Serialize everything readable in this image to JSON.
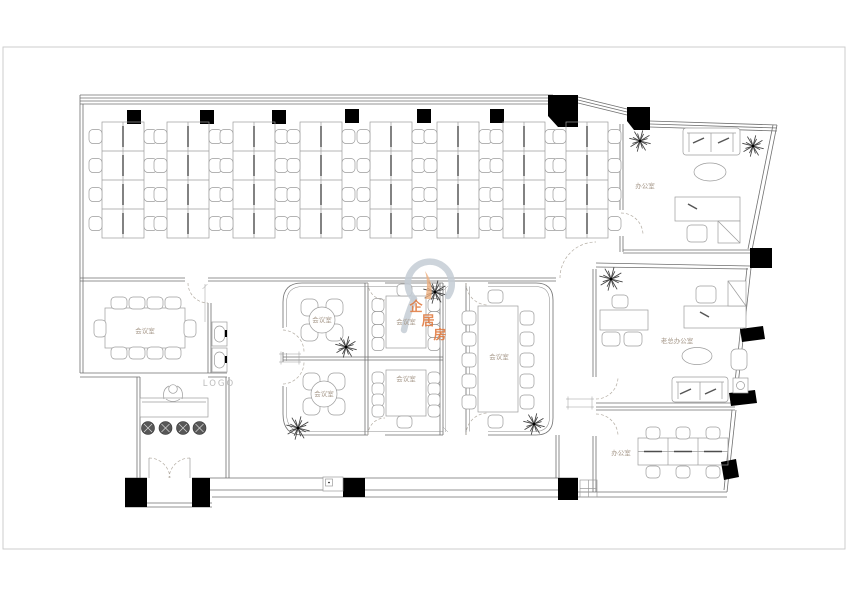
{
  "page": {
    "type": "office-floor-plan"
  },
  "labels": {
    "conf_left": "会议室",
    "conf_small_tl": "会议室",
    "conf_small_bl": "会议室",
    "conf_mid_tr": "会议室",
    "conf_mid_br": "会议室",
    "conf_main": "会议室",
    "office_top_right": "办公室",
    "boss_office": "老总办公室",
    "office_bottom_right": "办公室",
    "logo": "LOGO"
  },
  "watermark": {
    "text": "企居房",
    "color": "#e0763a",
    "swirl_color": "#c4cdd5"
  },
  "colors": {
    "wall": "#6f6f6f",
    "furniture": "#9c9c9c",
    "column": "#000000",
    "label": "#a6988a",
    "page_border": "#c9c9c9"
  }
}
